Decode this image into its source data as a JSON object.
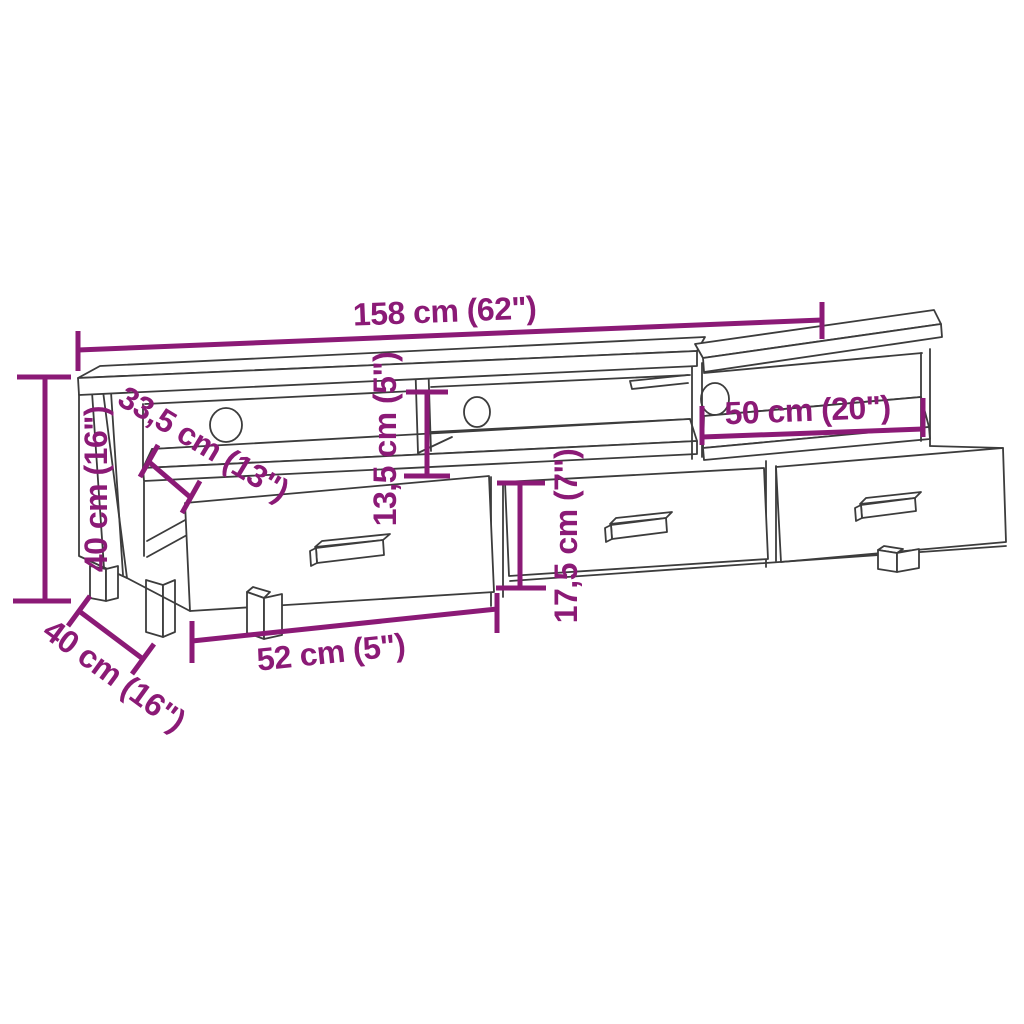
{
  "figure": {
    "title": "TV cabinet dimension diagram",
    "background_color": "#ffffff",
    "artwork_line_color": "#3c3c3c",
    "dimension_color": "#8b1a76",
    "product": {
      "type": "TV stand with 3 drawers, 3 open compartments and cable holes",
      "drawer_count": 3,
      "open_compartment_count": 3,
      "cable_hole_count": 3
    },
    "dimensions": [
      {
        "id": "total_width",
        "label": "158 cm (62\")",
        "cm": "158",
        "inches": "62\"",
        "placement": "top"
      },
      {
        "id": "height",
        "label": "40 cm (16\")",
        "cm": "40",
        "inches": "16\"",
        "placement": "left-vertical"
      },
      {
        "id": "top_depth",
        "label": "33,5 cm (13\")",
        "cm": "33,5",
        "inches": "13\"",
        "placement": "upper-left-diagonal"
      },
      {
        "id": "compartment_height",
        "label": "13,5 cm (5\")",
        "cm": "13,5",
        "inches": "5\"",
        "placement": "center-vertical"
      },
      {
        "id": "drawer_front_height",
        "label": "17,5 cm (7\")",
        "cm": "17,5",
        "inches": "7\"",
        "placement": "center-vertical"
      },
      {
        "id": "compartment_width",
        "label": "50 cm (20\")",
        "cm": "50",
        "inches": "20\"",
        "placement": "right-horizontal"
      },
      {
        "id": "drawer_width",
        "label": "52 cm (5\")",
        "cm": "52",
        "inches": "5\"",
        "placement": "bottom-horizontal"
      },
      {
        "id": "depth",
        "label": "40 cm (16\")",
        "cm": "40",
        "inches": "16\"",
        "placement": "bottom-left-diagonal"
      }
    ]
  }
}
